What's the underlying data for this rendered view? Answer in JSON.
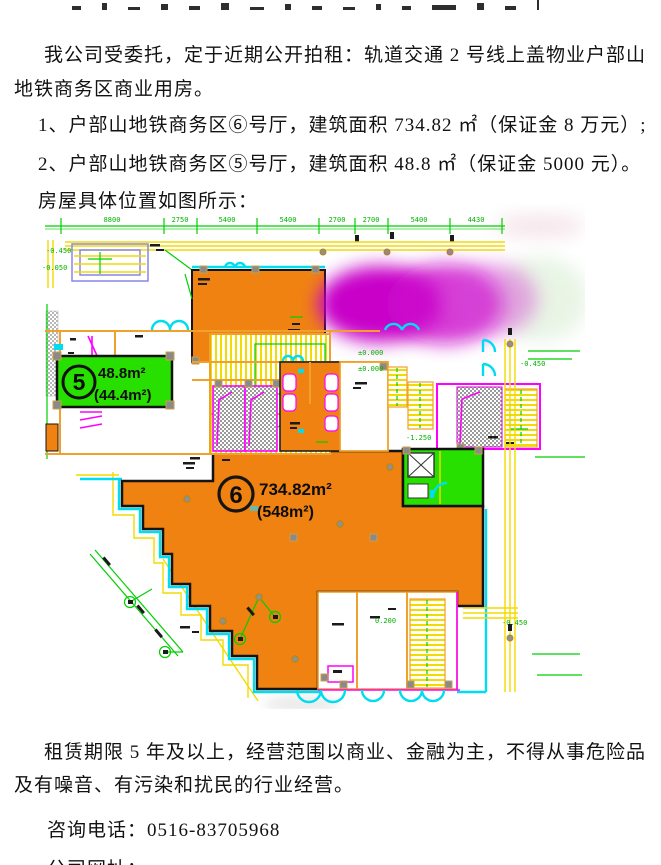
{
  "document": {
    "intro_line1": "我公司受委托，定于近期公开拍租：轨道交通 2 号线上盖物业户部山",
    "intro_line2": "地铁商务区商业用房。",
    "item1": "1、户部山地铁商务区⑥号厅，建筑面积 734.82 ㎡（保证金 8 万元）;",
    "item2": "2、户部山地铁商务区⑤号厅，建筑面积 48.8 ㎡（保证金 5000 元）。",
    "figure_caption": "房屋具体位置如图所示：",
    "terms_line1": "租赁期限 5 年及以上，经营范围以商业、金融为主，不得从事危险品",
    "terms_line2": "及有噪音、有污染和扰民的行业经营。",
    "phone_label": "咨询电话：",
    "phone_number": "0516-83705968",
    "website_label": "公司网址：",
    "website_url": "www.xzzqpm.com"
  },
  "floorplan": {
    "unit5": {
      "number": "5",
      "area": "48.8m²",
      "area_paren": "(44.4m²)",
      "fill": "#28e000"
    },
    "unit6": {
      "number": "6",
      "area": "734.82m²",
      "area_paren": "(548m²)",
      "fill": "#f08212"
    },
    "dimension_labels": [
      "8800",
      "2750",
      "5400",
      "5400",
      "2700",
      "2700",
      "5400",
      "4430"
    ],
    "level_labels": [
      "±0.000",
      "±0.000",
      "-0.450",
      "-0.450",
      "-0.450",
      "-0.050",
      "-1.250",
      "0.200"
    ],
    "colors": {
      "unit6_orange": "#f08212",
      "unit5_green": "#28e000",
      "redaction_magenta": "#c803c8",
      "cad_yellow": "#f2dc00",
      "cad_green": "#00cf00",
      "cad_cyan": "#00dcf0",
      "cad_magenta": "#ff00ff",
      "wall_orange": "#f0a02c"
    }
  }
}
